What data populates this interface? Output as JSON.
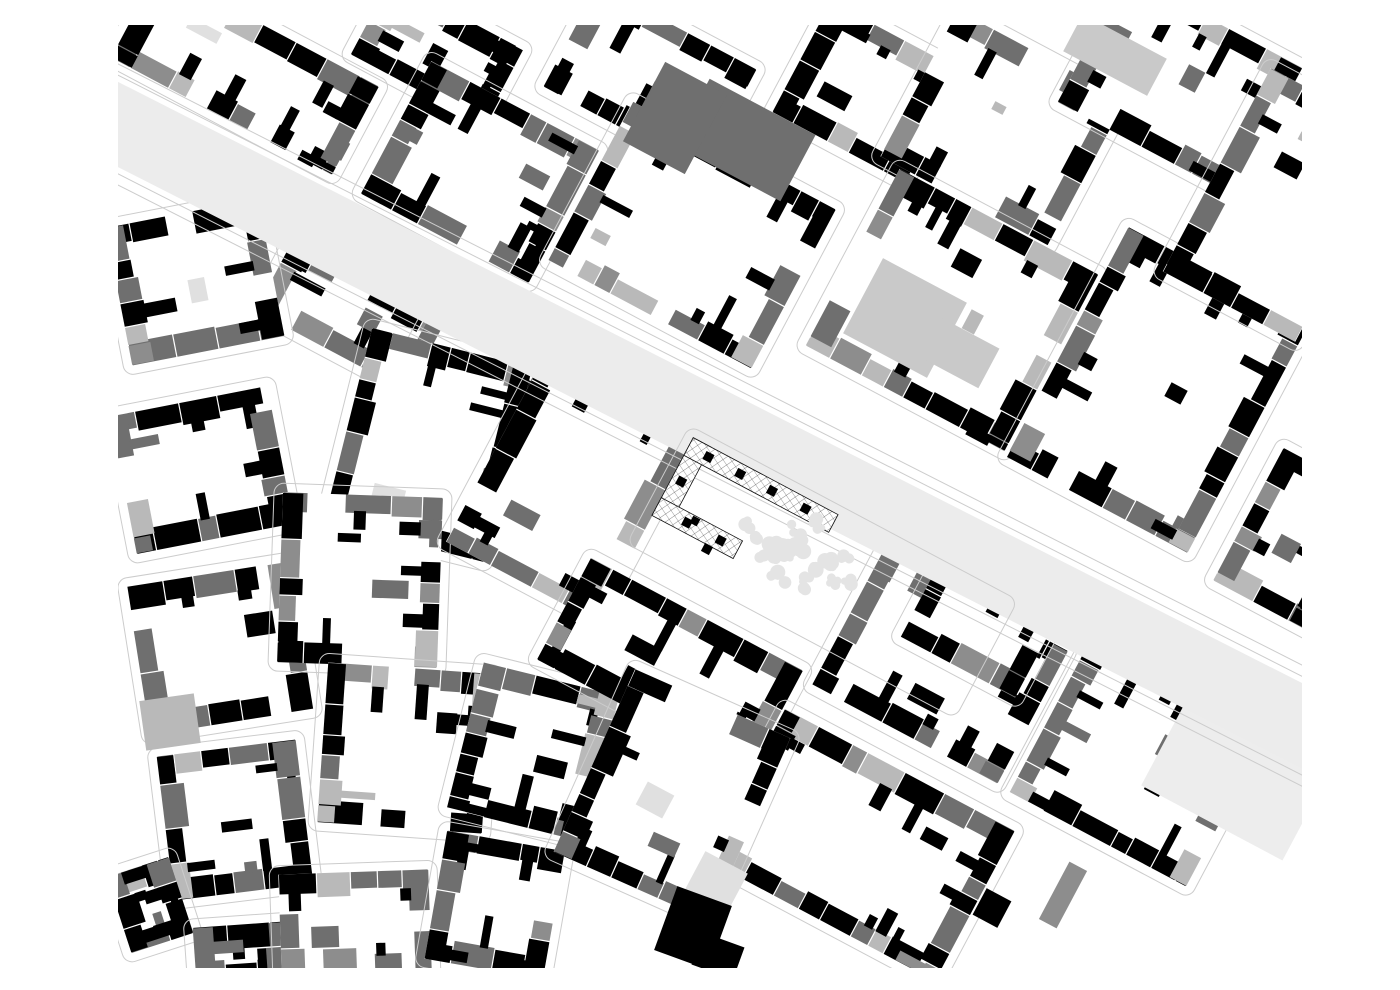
{
  "canvas": {
    "width": 1400,
    "height": 990,
    "background": "#ffffff"
  },
  "palette": {
    "black": "#000000",
    "dark": "#6f6f6f",
    "gray": "#8d8d8d",
    "light": "#b9b9b9",
    "pale": "#c9c9c9",
    "faint": "#e0e0e0",
    "court": "#ffffff",
    "street_fill": "#ececec",
    "street_line": "#cccccc",
    "plaza": "#ededed",
    "tree": "#e4e4e4",
    "hatch_line": "#3a3a3a",
    "site_outline": "#111111"
  },
  "map_bounds": {
    "x": 118,
    "y": 25,
    "w": 1184,
    "h": 943
  },
  "boulevard": {
    "x1": 60,
    "y1": 95,
    "x2": 1340,
    "y2": 745,
    "width": 76,
    "line_offsets": [
      44,
      54
    ]
  },
  "site": {
    "cx": 745,
    "cy": 515,
    "rot": 28,
    "outer_w": 164,
    "outer_h": 88,
    "band": 20,
    "bottom_arm": 92,
    "hatch_spacing": 6.5,
    "square_size": 9,
    "squares": [
      [
        -64,
        -38.5
      ],
      [
        -28,
        -38.5
      ],
      [
        8,
        -38.5
      ],
      [
        46,
        -38.5
      ],
      [
        -76.5,
        -4
      ],
      [
        -52,
        29.5
      ],
      [
        -14,
        29.5
      ]
    ],
    "outline_inflate": 9
  },
  "trees": {
    "cx": 800,
    "cy": 556,
    "rx": 62,
    "ry": 40,
    "rot": 28,
    "count": 26,
    "seed": 77
  },
  "blocks": [
    {
      "cx": 245,
      "cy": 72,
      "w": 250,
      "h": 100,
      "rot": 28,
      "seed": 11,
      "tone": 0.15
    },
    {
      "cx": 437,
      "cy": 52,
      "w": 150,
      "h": 85,
      "rot": 28,
      "seed": 12,
      "tone": 0.15
    },
    {
      "cx": 480,
      "cy": 172,
      "w": 190,
      "h": 150,
      "rot": 28,
      "seed": 13,
      "tone": 0.18
    },
    {
      "cx": 650,
      "cy": 78,
      "w": 180,
      "h": 115,
      "rot": 28,
      "seed": 14,
      "tone": 0.15
    },
    {
      "cx": 692,
      "cy": 235,
      "w": 230,
      "h": 180,
      "rot": 28,
      "seed": 15,
      "tone": 0.12
    },
    {
      "cx": 868,
      "cy": 92,
      "w": 150,
      "h": 125,
      "rot": 28,
      "seed": 16,
      "tone": 0.18
    },
    {
      "cx": 1003,
      "cy": 128,
      "w": 190,
      "h": 165,
      "rot": 28,
      "seed": 17,
      "tone": 0.15
    },
    {
      "cx": 1180,
      "cy": 85,
      "w": 200,
      "h": 145,
      "rot": 28,
      "seed": 18,
      "tone": 0.2
    },
    {
      "cx": 952,
      "cy": 310,
      "w": 225,
      "h": 200,
      "rot": 28,
      "seed": 19,
      "tone": 0.22
    },
    {
      "cx": 1158,
      "cy": 390,
      "w": 205,
      "h": 260,
      "rot": 28,
      "seed": 20,
      "tone": 0.15
    },
    {
      "cx": 1283,
      "cy": 205,
      "w": 150,
      "h": 230,
      "rot": 28,
      "seed": 21,
      "tone": 0.2
    },
    {
      "cx": 1297,
      "cy": 540,
      "w": 110,
      "h": 150,
      "rot": 28,
      "seed": 22,
      "tone": 0.15
    },
    {
      "cx": 358,
      "cy": 320,
      "w": 190,
      "h": 80,
      "rot": 28,
      "seed": 23,
      "tone": 0.2
    },
    {
      "cx": 490,
      "cy": 352,
      "w": 140,
      "h": 85,
      "rot": 28,
      "seed": 24,
      "tone": 0.2
    },
    {
      "cx": 195,
      "cy": 282,
      "w": 155,
      "h": 140,
      "rot": -11,
      "seed": 25,
      "tone": 0.3
    },
    {
      "cx": 202,
      "cy": 470,
      "w": 160,
      "h": 140,
      "rot": -11,
      "seed": 26,
      "tone": 0.3
    },
    {
      "cx": 220,
      "cy": 648,
      "w": 165,
      "h": 150,
      "rot": -9,
      "seed": 27,
      "tone": 0.3
    },
    {
      "cx": 235,
      "cy": 820,
      "w": 140,
      "h": 145,
      "rot": -7,
      "seed": 28,
      "tone": 0.3
    },
    {
      "cx": 150,
      "cy": 905,
      "w": 65,
      "h": 80,
      "rot": -18,
      "seed": 29,
      "tone": 0.25
    },
    {
      "cx": 242,
      "cy": 952,
      "w": 95,
      "h": 55,
      "rot": -4,
      "seed": 30,
      "tone": 0.25
    },
    {
      "cx": 428,
      "cy": 445,
      "w": 165,
      "h": 200,
      "rot": 14,
      "seed": 31,
      "tone": 0.25
    },
    {
      "cx": 360,
      "cy": 580,
      "w": 160,
      "h": 170,
      "rot": 2,
      "seed": 32,
      "tone": 0.3
    },
    {
      "cx": 405,
      "cy": 748,
      "w": 165,
      "h": 160,
      "rot": 4,
      "seed": 33,
      "tone": 0.3
    },
    {
      "cx": 355,
      "cy": 922,
      "w": 150,
      "h": 100,
      "rot": -2,
      "seed": 34,
      "tone": 0.3
    },
    {
      "cx": 495,
      "cy": 905,
      "w": 120,
      "h": 130,
      "rot": 10,
      "seed": 35,
      "tone": 0.28
    },
    {
      "cx": 533,
      "cy": 752,
      "w": 140,
      "h": 150,
      "rot": 14,
      "seed": 36,
      "tone": 0.28
    },
    {
      "cx": 575,
      "cy": 480,
      "w": 170,
      "h": 230,
      "rot": 28,
      "seed": 37,
      "tone": 0.12
    },
    {
      "cx": 670,
      "cy": 665,
      "w": 240,
      "h": 115,
      "rot": 28,
      "seed": 38,
      "tone": 0.08
    },
    {
      "cx": 940,
      "cy": 668,
      "w": 210,
      "h": 150,
      "rot": 28,
      "seed": 39,
      "tone": 0.15
    },
    {
      "cx": 1140,
      "cy": 760,
      "w": 200,
      "h": 180,
      "rot": 28,
      "seed": 40,
      "tone": 0.15
    },
    {
      "cx": 860,
      "cy": 845,
      "w": 260,
      "h": 170,
      "rot": 28,
      "seed": 41,
      "tone": 0.1
    },
    {
      "cx": 672,
      "cy": 795,
      "w": 170,
      "h": 200,
      "rot": 24,
      "seed": 42,
      "tone": 0.2
    },
    {
      "cx": 980,
      "cy": 625,
      "w": 130,
      "h": 95,
      "rot": 28,
      "seed": 43,
      "tone": 0.05
    }
  ],
  "landmarks": [
    {
      "x": 745,
      "y": 140,
      "w": 120,
      "h": 75,
      "rot": 28,
      "color": "dark"
    },
    {
      "x": 675,
      "y": 118,
      "w": 70,
      "h": 90,
      "rot": 28,
      "color": "dark"
    },
    {
      "x": 905,
      "y": 318,
      "w": 95,
      "h": 85,
      "rot": 28,
      "color": "pale"
    },
    {
      "x": 958,
      "y": 352,
      "w": 70,
      "h": 45,
      "rot": 28,
      "color": "pale"
    },
    {
      "x": 1115,
      "y": 55,
      "w": 95,
      "h": 42,
      "rot": 28,
      "color": "pale"
    },
    {
      "x": 713,
      "y": 888,
      "w": 48,
      "h": 58,
      "rot": 28,
      "color": "faint"
    },
    {
      "x": 655,
      "y": 800,
      "w": 30,
      "h": 26,
      "rot": 28,
      "color": "faint"
    },
    {
      "x": 1063,
      "y": 895,
      "w": 20,
      "h": 65,
      "rot": 28,
      "color": "gray"
    },
    {
      "x": 992,
      "y": 908,
      "w": 28,
      "h": 30,
      "rot": 28,
      "color": "black"
    },
    {
      "x": 170,
      "y": 722,
      "w": 55,
      "h": 50,
      "rot": -8,
      "color": "light"
    },
    {
      "x": 1240,
      "y": 770,
      "w": 160,
      "h": 120,
      "rot": 28,
      "color": "plaza"
    },
    {
      "x": 693,
      "y": 928,
      "w": 58,
      "h": 68,
      "rot": 20,
      "color": "black"
    },
    {
      "x": 718,
      "y": 956,
      "w": 44,
      "h": 34,
      "rot": 20,
      "color": "black"
    }
  ],
  "site_dots": [
    {
      "x": 695,
      "y": 521,
      "s": 8
    },
    {
      "x": 707,
      "y": 549,
      "s": 9
    }
  ]
}
